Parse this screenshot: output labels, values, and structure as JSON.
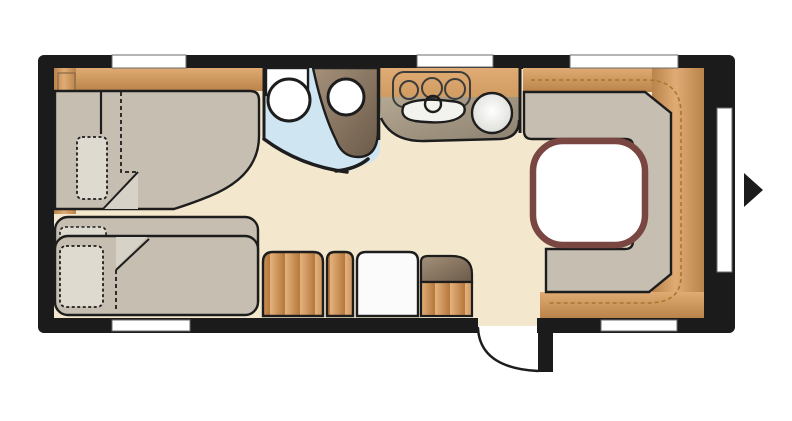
{
  "plan": {
    "kind": "caravan floor plan",
    "window_count": 6,
    "hob_burner_count": 3,
    "bed_count": 3,
    "entry": {
      "arrow_glyph": "right-pointing-triangle",
      "door_swing": "quarter-arc"
    }
  },
  "colors": {
    "wall": "#1b1b1b",
    "outline": "#1d1d1d",
    "floor": "#f3e7cd",
    "bathroom_floor": "#cfe5f2",
    "upholstery": "#c6bfb1",
    "pillow": "#dedacf",
    "fold_light": "#d7d2c7",
    "wood_light": "#e0ab74",
    "wood_mid": "#cf9a5f",
    "wood_dark": "#b9834b",
    "plank_light": "#e4b37d",
    "plank_dark": "#b5773c",
    "taupe_light": "#a5917a",
    "taupe_dark": "#6b5a49",
    "counter_light": "#b4a893",
    "counter_dark": "#8d8170",
    "fixture_white": "#ffffff",
    "sink_white": "#f2f2ef",
    "cabinet_white": "#fbfbfb",
    "table_border": "#7a4642",
    "stitch": "#a8762f",
    "window_fill": "#ffffff",
    "window_edge": "#6b6b6b",
    "bowl_edge_tint": "#d8d8d3"
  }
}
